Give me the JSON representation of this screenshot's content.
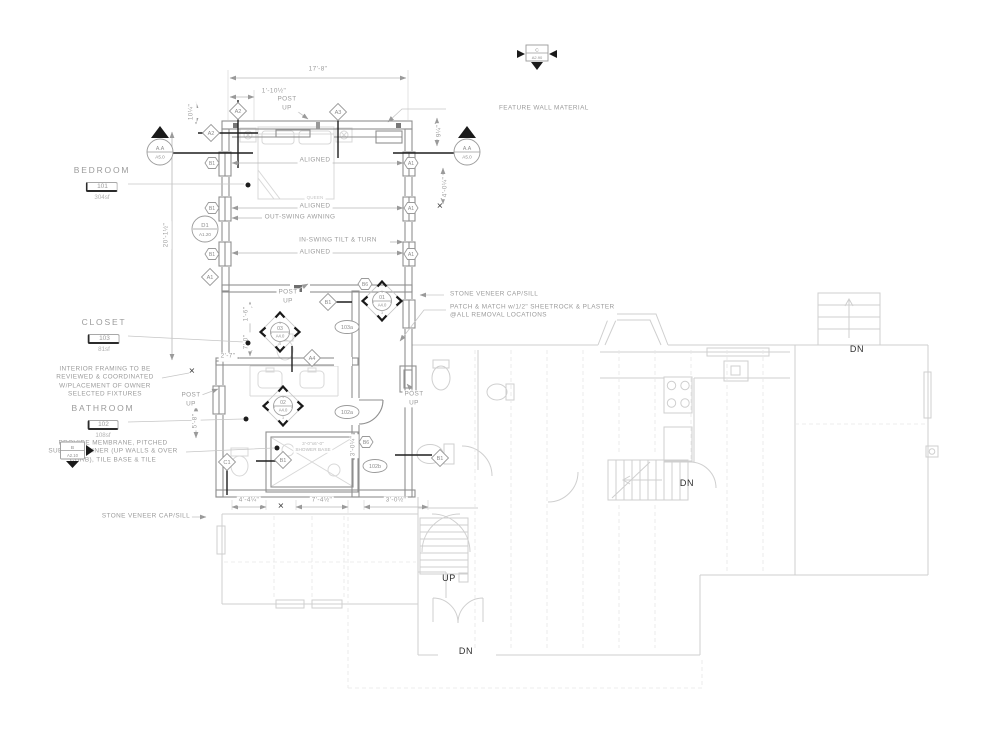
{
  "drawing": {
    "type": "residential floor plan - bedroom and bathroom addition",
    "stair_direction_labels": [
      "UP",
      "DN"
    ]
  },
  "colors": {
    "background": "#ffffff",
    "new_work_line": "#8f8f8f",
    "existing_line": "#cfcfcf",
    "dark_accent": "#1f1f1f",
    "annotation_text": "#9b9b9b",
    "dark_text": "#2e2e2e"
  },
  "rooms": [
    {
      "name": "BEDROOM",
      "tag": "101",
      "area": "304sf",
      "x": 102,
      "y": 165
    },
    {
      "name": "CLOSET",
      "tag": "103",
      "area": "81sf",
      "x": 104,
      "y": 317
    },
    {
      "name": "BATHROOM",
      "tag": "102",
      "area": "108sf",
      "x": 103,
      "y": 403
    }
  ],
  "labels": [
    {
      "name": "dim-overall-width",
      "text": "17'-8\"",
      "x": 318,
      "y": 70
    },
    {
      "name": "dim-1-10half",
      "text": "1'-10½\"",
      "x": 274,
      "y": 92
    },
    {
      "name": "dim-10quarter",
      "text": "10¼\"",
      "x": 192,
      "y": 112,
      "rot": -90
    },
    {
      "name": "dim-9quarter",
      "text": "9¼\"",
      "x": 440,
      "y": 131,
      "rot": -90
    },
    {
      "name": "dim-20-1half",
      "text": "20'-1½\"",
      "x": 167,
      "y": 235,
      "rot": -90
    },
    {
      "name": "dim-4-0quarter",
      "text": "4'-0¼\"",
      "x": 446,
      "y": 187,
      "rot": -90
    },
    {
      "name": "dim-1-6",
      "text": "1'-6\"",
      "x": 247,
      "y": 314,
      "rot": -90
    },
    {
      "name": "dim-7-0",
      "text": "7'-0\"",
      "x": 247,
      "y": 342,
      "rot": -90
    },
    {
      "name": "dim-2-7",
      "text": "2'-7\"",
      "x": 228,
      "y": 357
    },
    {
      "name": "dim-5-8",
      "text": "5'-8\"",
      "x": 196,
      "y": 421,
      "rot": -90
    },
    {
      "name": "dim-3-0quarter",
      "text": "3'-0¼\"",
      "x": 354,
      "y": 446,
      "rot": -90
    },
    {
      "name": "dim-4-4quarter",
      "text": "4'-4¼\"",
      "x": 249,
      "y": 501
    },
    {
      "name": "dim-7-4half",
      "text": "7'-4½\"",
      "x": 322,
      "y": 501
    },
    {
      "name": "dim-3-0half",
      "text": "3'-0½\"",
      "x": 396,
      "y": 501
    },
    {
      "name": "dim-tick-x-1",
      "text": "✕",
      "x": 281,
      "y": 507,
      "cls": "xmark"
    },
    {
      "name": "dim-tick-x-2",
      "text": "✕",
      "x": 440,
      "y": 207,
      "cls": "xmark"
    },
    {
      "name": "dim-tick-x-3",
      "text": "✕",
      "x": 192,
      "y": 372,
      "cls": "xmark"
    },
    {
      "name": "note-feature-wall",
      "text": "FEATURE WALL MATERIAL",
      "x": 497,
      "y": 109,
      "cls": "left"
    },
    {
      "name": "label-post-up-top",
      "text": "POST\nUP",
      "x": 287,
      "y": 104
    },
    {
      "name": "label-aligned-1",
      "text": "ALIGNED",
      "x": 315,
      "y": 161
    },
    {
      "name": "label-queen",
      "text": "QUEEN",
      "x": 315,
      "y": 198,
      "cls": "tiny faint"
    },
    {
      "name": "label-aligned-2",
      "text": "ALIGNED",
      "x": 315,
      "y": 207
    },
    {
      "name": "label-out-swing",
      "text": "OUT-SWING AWNING",
      "x": 300,
      "y": 218
    },
    {
      "name": "label-in-swing",
      "text": "IN-SWING TILT & TURN",
      "x": 338,
      "y": 241
    },
    {
      "name": "label-aligned-3",
      "text": "ALIGNED",
      "x": 315,
      "y": 253
    },
    {
      "name": "note-stone-veneer-right",
      "text": "STONE VENEER CAP/SILL",
      "x": 448,
      "y": 295,
      "cls": "left"
    },
    {
      "name": "note-patch-match",
      "text": "PATCH & MATCH w/1/2\" SHEETROCK & PLASTER\n@ALL REMOVAL LOCATIONS",
      "x": 448,
      "y": 312,
      "cls": "left note"
    },
    {
      "name": "note-stone-veneer-left",
      "text": "STONE VENEER CAP/SILL",
      "x": 146,
      "y": 517
    },
    {
      "name": "note-interior-framing",
      "text": "INTERIOR FRAMING TO BE\nREVIEWED & COORDINATED\nW/PLACEMENT OF OWNER\nSELECTED FIXTURES",
      "x": 105,
      "y": 382,
      "cls": "note"
    },
    {
      "name": "note-membrane",
      "text": "PROVIDE MEMBRANE, PITCHED\nSUB-BASE, LINER (UP WALLS & OVER\nCURB), TILE BASE & TILE",
      "x": 113,
      "y": 452,
      "cls": "note"
    },
    {
      "name": "label-post-up-left",
      "text": "POST\nUP",
      "x": 191,
      "y": 400
    },
    {
      "name": "label-post-up-mid",
      "text": "POST\nUP",
      "x": 288,
      "y": 297
    },
    {
      "name": "label-post-up-right",
      "text": "POST\nUP",
      "x": 414,
      "y": 399
    },
    {
      "name": "label-shower-base",
      "text": "3'-0\"x6'-0\"\nSHOWER BASE",
      "x": 313,
      "y": 447,
      "cls": "tiny"
    },
    {
      "name": "label-up",
      "text": "UP",
      "x": 449,
      "y": 578,
      "cls": "dark"
    },
    {
      "name": "label-dn-entry",
      "text": "DN",
      "x": 466,
      "y": 651,
      "cls": "dark"
    },
    {
      "name": "label-dn-stair",
      "text": "DN",
      "x": 687,
      "y": 483,
      "cls": "dark"
    },
    {
      "name": "label-dn-stoop",
      "text": "DN",
      "x": 857,
      "y": 349,
      "cls": "dark"
    }
  ],
  "markers": [
    {
      "type": "section-square",
      "label": "C",
      "sub": "A2.90",
      "x": 537,
      "y": 57,
      "name": "section-marker-c"
    },
    {
      "type": "elev-circle",
      "label": "A.A",
      "sub": "A5.0",
      "x": 160,
      "y": 146,
      "name": "elevation-marker-aa-left"
    },
    {
      "type": "elev-circle",
      "label": "A.A",
      "sub": "A5.0",
      "x": 467,
      "y": 146,
      "name": "elevation-marker-aa-right"
    },
    {
      "type": "elev-square",
      "label": "B",
      "sub": "A2.10",
      "x": 78,
      "y": 452,
      "name": "elevation-marker-b"
    },
    {
      "type": "circle2",
      "label": "D1",
      "sub": "A1.20",
      "x": 205,
      "y": 229,
      "name": "door-tag-d1"
    },
    {
      "type": "int-elev",
      "label": "03",
      "sub": "A4.0",
      "x": 280,
      "y": 332,
      "name": "interior-elevation-03"
    },
    {
      "type": "int-elev",
      "label": "01",
      "sub": "A4.0",
      "x": 382,
      "y": 301,
      "name": "interior-elevation-01"
    },
    {
      "type": "int-elev",
      "label": "02",
      "sub": "A4.0",
      "x": 283,
      "y": 406,
      "name": "interior-elevation-02"
    },
    {
      "type": "diamond",
      "label": "A2",
      "x": 238,
      "y": 111
    },
    {
      "type": "diamond",
      "label": "A2",
      "x": 211,
      "y": 133
    },
    {
      "type": "diamond",
      "label": "A3",
      "x": 338,
      "y": 112
    },
    {
      "type": "diamond",
      "label": "A1",
      "x": 210,
      "y": 277
    },
    {
      "type": "diamond",
      "label": "A4",
      "x": 312,
      "y": 358
    },
    {
      "type": "diamond",
      "label": "C1",
      "x": 227,
      "y": 462
    },
    {
      "type": "diamond",
      "label": "B1",
      "x": 283,
      "y": 460
    },
    {
      "type": "diamond",
      "label": "B1",
      "x": 328,
      "y": 302
    },
    {
      "type": "diamond",
      "label": "B1",
      "x": 440,
      "y": 458
    },
    {
      "type": "hex",
      "label": "B1",
      "x": 212,
      "y": 163
    },
    {
      "type": "hex",
      "label": "B1",
      "x": 212,
      "y": 208
    },
    {
      "type": "hex",
      "label": "B1",
      "x": 212,
      "y": 254
    },
    {
      "type": "hex",
      "label": "A1",
      "x": 411,
      "y": 163
    },
    {
      "type": "hex",
      "label": "A1",
      "x": 411,
      "y": 208
    },
    {
      "type": "hex",
      "label": "A1",
      "x": 411,
      "y": 254
    },
    {
      "type": "hex",
      "label": "B6",
      "x": 365,
      "y": 284
    },
    {
      "type": "hex",
      "label": "B6",
      "x": 366,
      "y": 442
    },
    {
      "type": "oval",
      "label": "103a",
      "x": 347,
      "y": 327
    },
    {
      "type": "oval",
      "label": "102a",
      "x": 347,
      "y": 412
    },
    {
      "type": "oval",
      "label": "102b",
      "x": 375,
      "y": 466
    }
  ],
  "dots": [
    [
      248,
      185
    ],
    [
      248,
      343
    ],
    [
      246,
      419
    ],
    [
      277,
      448
    ]
  ]
}
